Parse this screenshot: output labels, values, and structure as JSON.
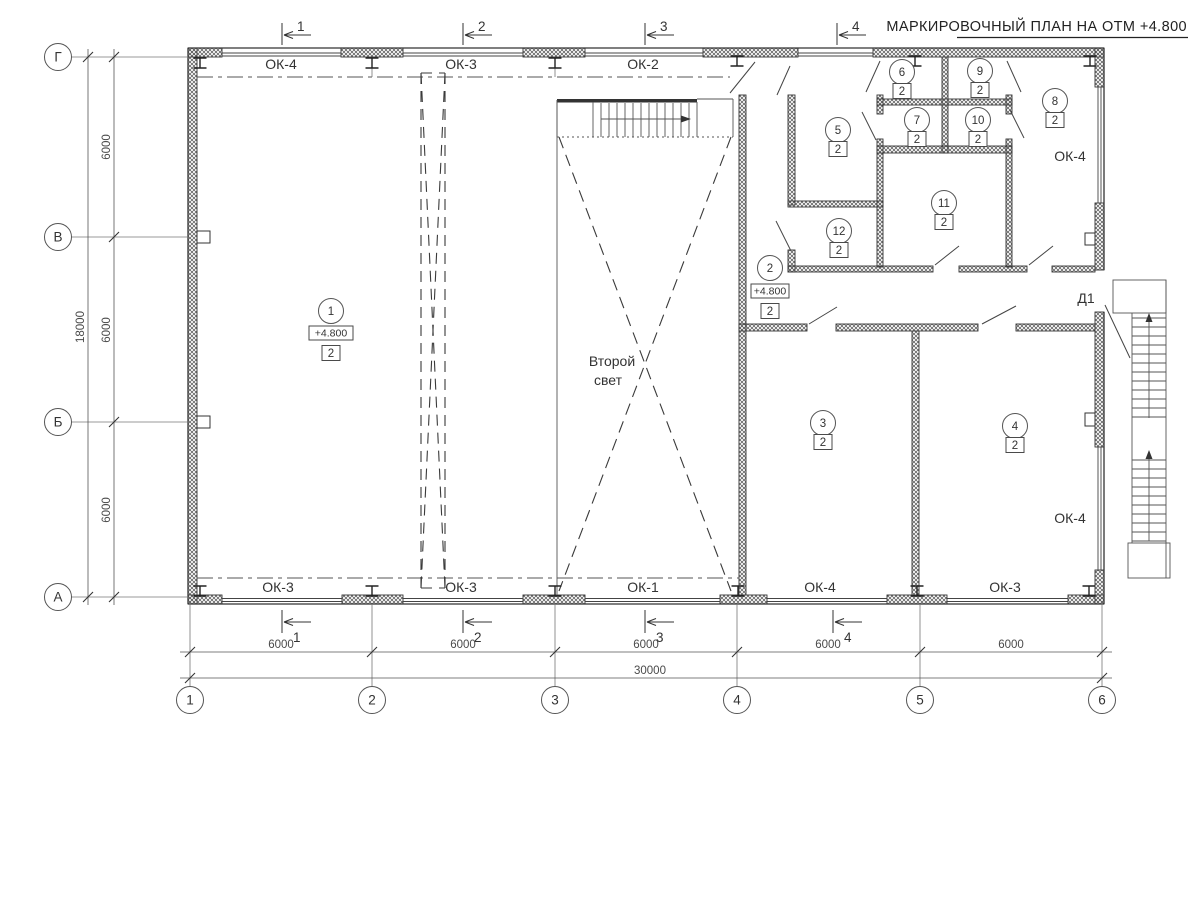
{
  "title": "МАРКИРОВОЧНЫЙ ПЛАН НА ОТМ +4.800",
  "axes": {
    "cols": [
      "1",
      "2",
      "3",
      "4",
      "5",
      "6"
    ],
    "rows": [
      "Г",
      "В",
      "Б",
      "А"
    ]
  },
  "dims": {
    "col_spacing": [
      "6000",
      "6000",
      "6000",
      "6000",
      "6000"
    ],
    "col_total": "30000",
    "row_spacing": [
      "6000",
      "6000",
      "6000"
    ],
    "row_total": "18000"
  },
  "sections": [
    "1",
    "2",
    "3",
    "4"
  ],
  "windows": {
    "top": [
      "ОК-4",
      "ОК-3",
      "ОК-2"
    ],
    "bottom": [
      "ОК-3",
      "ОК-3",
      "ОК-1",
      "ОК-4",
      "ОК-3"
    ],
    "right": [
      "ОК-4",
      "ОК-4"
    ]
  },
  "door_label": "Д1",
  "second_light": [
    "Второй",
    "свет"
  ],
  "rooms": [
    {
      "num": "1",
      "type": "2",
      "elev": "+4.800"
    },
    {
      "num": "2",
      "type": "2",
      "elev": "+4.800"
    },
    {
      "num": "3",
      "type": "2"
    },
    {
      "num": "4",
      "type": "2"
    },
    {
      "num": "5",
      "type": "2"
    },
    {
      "num": "6",
      "type": "2"
    },
    {
      "num": "7",
      "type": "2"
    },
    {
      "num": "8",
      "type": "2"
    },
    {
      "num": "9",
      "type": "2"
    },
    {
      "num": "10",
      "type": "2"
    },
    {
      "num": "11",
      "type": "2"
    },
    {
      "num": "12",
      "type": "2"
    }
  ]
}
